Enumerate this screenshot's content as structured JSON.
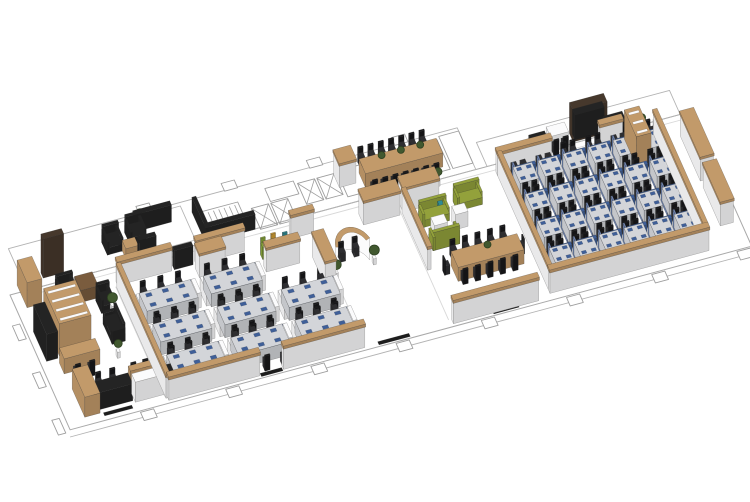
{
  "meta": {
    "description": "Axonometric 3D render of a long open-plan office floor",
    "canvas_width": 750,
    "canvas_height": 502,
    "background": "#ffffff"
  },
  "palette": {
    "white": "#fbfbfc",
    "desk": "#d3d5d9",
    "panel": "#3f5f98",
    "panel2": "#7288b4",
    "wood": "#c29a6a",
    "brown": "#7a5c3e",
    "darkbrown": "#46382c",
    "black": "#242424",
    "chairc": "#2e2e31",
    "chairdark": "#18181a",
    "green": "#93a13b",
    "green2": "#86a437",
    "yellow": "#d09d33",
    "teal": "#2e8b94",
    "plantc": "#41582f",
    "plantedge": "#2c3f20",
    "mat": "#1d1d1d",
    "line": "#b3b3b3",
    "linesoft": "#d8d8d8",
    "linedark": "#9e9e9e",
    "slabedge": "#a9a9a9"
  },
  "projection": {
    "origin": [
      10,
      295
    ],
    "ux": [
      0.284,
      -0.0765
    ],
    "vy": [
      0.143,
      0.321
    ],
    "hz": 0.5
  },
  "zones": [
    {
      "id": "floor-slab",
      "label": "Floor slab, core linework and columns",
      "items": [
        {
          "k": "floorfill",
          "x": 0,
          "y": 0,
          "w": 2400,
          "d": 420
        },
        {
          "k": "outline",
          "x": 60,
          "y": -130,
          "w": 1580,
          "d": 130,
          "c": "line"
        },
        {
          "k": "outline",
          "x": 1680,
          "y": -75,
          "w": 680,
          "d": 75,
          "c": "line"
        },
        {
          "k": "outline",
          "x": 420,
          "y": -120,
          "w": 240,
          "d": 106,
          "c": "line"
        },
        {
          "k": "line",
          "x1": 60,
          "y1": 16,
          "x2": 2400,
          "y2": 16,
          "c": "linesoft"
        },
        {
          "k": "line",
          "x1": 344,
          "y1": 56,
          "x2": 344,
          "y2": 398,
          "c": "linesoft"
        },
        {
          "k": "line",
          "x1": 1046,
          "y1": 56,
          "x2": 1046,
          "y2": 398,
          "c": "linesoft"
        },
        {
          "k": "line",
          "x1": 1344,
          "y1": 56,
          "x2": 1344,
          "y2": 398,
          "c": "linesoft"
        },
        {
          "k": "line",
          "x1": -10,
          "y1": 440,
          "x2": 2404,
          "y2": 440,
          "c": "line"
        },
        {
          "k": "stairs",
          "x": 706,
          "y": -88,
          "w": 140,
          "d": 86,
          "n": 7
        },
        {
          "k": "xroom",
          "x": 880,
          "y": -60,
          "w": 60,
          "d": 65
        },
        {
          "k": "xroom",
          "x": 948,
          "y": -60,
          "w": 60,
          "d": 65
        },
        {
          "k": "xroom",
          "x": 1060,
          "y": -95,
          "w": 60,
          "d": 65
        },
        {
          "k": "xroom",
          "x": 1128,
          "y": -95,
          "w": 60,
          "d": 65
        },
        {
          "k": "outline",
          "x": 950,
          "y": -105,
          "w": 100,
          "d": 40,
          "c": "linedark"
        },
        {
          "k": "outline",
          "x": 1200,
          "y": -100,
          "w": 110,
          "d": 80,
          "c": "linedark"
        },
        {
          "k": "outline",
          "x": 1380,
          "y": -112,
          "w": 56,
          "d": 92,
          "c": "linedark"
        },
        {
          "k": "outline",
          "x": 1442,
          "y": -112,
          "w": 56,
          "d": 92,
          "c": "linedark"
        },
        {
          "k": "outline",
          "x": 1504,
          "y": -112,
          "w": 56,
          "d": 92,
          "c": "linedark"
        },
        {
          "k": "outline",
          "x": 1570,
          "y": -120,
          "w": 70,
          "d": 100,
          "c": "linedark"
        },
        {
          "k": "box",
          "x": 480,
          "y": -95,
          "w": 130,
          "d": 13,
          "h": 34,
          "c": "black"
        },
        {
          "k": "box",
          "x": 688,
          "y": -94,
          "w": 14,
          "d": 96,
          "h": 30,
          "c": "black"
        },
        {
          "k": "box",
          "x": 688,
          "y": -12,
          "w": 175,
          "d": 13,
          "h": 30,
          "c": "black"
        },
        {
          "k": "box",
          "x": 455,
          "y": -12,
          "w": 60,
          "d": 12,
          "h": 40,
          "c": "black"
        },
        {
          "k": "colrun",
          "x": 246,
          "y": 424,
          "n": 8,
          "dx": 300,
          "w": 46,
          "d": 26
        },
        {
          "k": "colrun",
          "x": 520,
          "y": -152,
          "n": 4,
          "dx": 300,
          "w": 46,
          "d": 24
        },
        {
          "k": "colrun",
          "x": -36,
          "y": 88,
          "n": 1,
          "dx": 0,
          "w": 26,
          "d": 46
        },
        {
          "k": "colrun",
          "x": -40,
          "y": 236,
          "n": 1,
          "dx": 0,
          "w": 26,
          "d": 46
        },
        {
          "k": "colrun",
          "x": -44,
          "y": 380,
          "n": 1,
          "dx": 0,
          "w": 26,
          "d": 46
        }
      ]
    },
    {
      "id": "north-lounge",
      "label": "Informal lounge, dark sofas",
      "items": [
        {
          "k": "sofa",
          "x": 362,
          "y": -78,
          "w": 56,
          "d": 40,
          "dir": "s",
          "c": "black"
        },
        {
          "k": "sofa",
          "x": 448,
          "y": -88,
          "w": 56,
          "d": 40,
          "dir": "s",
          "c": "black"
        },
        {
          "k": "box",
          "x": 415,
          "y": -40,
          "w": 44,
          "d": 26,
          "h": 20,
          "c": "wood"
        },
        {
          "k": "plant",
          "x": 505,
          "y": -92,
          "s": 5
        }
      ]
    },
    {
      "id": "executive-suite",
      "label": "Executive suite with bookcase and lounge",
      "items": [
        {
          "k": "box",
          "x": 128,
          "y": -38,
          "w": 72,
          "d": 16,
          "h": 78,
          "c": "darkbrown"
        },
        {
          "k": "box",
          "x": 36,
          "y": -22,
          "w": 52,
          "d": 70,
          "h": 50,
          "c": "wood"
        },
        {
          "k": "box",
          "x": 22,
          "y": 120,
          "w": 40,
          "d": 92,
          "h": 54,
          "c": "black"
        },
        {
          "k": "sofa",
          "x": 146,
          "y": 26,
          "w": 58,
          "d": 44,
          "dir": "s",
          "c": "black"
        },
        {
          "k": "box",
          "x": 212,
          "y": 30,
          "w": 62,
          "d": 44,
          "h": 24,
          "c": "brown"
        },
        {
          "k": "sofa",
          "x": 262,
          "y": 80,
          "w": 44,
          "d": 40,
          "dir": "s",
          "c": "black"
        },
        {
          "k": "shelf",
          "x": 70,
          "y": 96,
          "w": 112,
          "d": 110,
          "h": 64,
          "c": "wood",
          "n": 4
        },
        {
          "k": "plant",
          "x": 300,
          "y": 120,
          "s": 5
        },
        {
          "k": "sofa",
          "x": 252,
          "y": 150,
          "w": 46,
          "d": 64,
          "dir": "w",
          "c": "black"
        },
        {
          "k": "box",
          "x": 60,
          "y": 226,
          "w": 126,
          "d": 34,
          "h": 30,
          "c": "wood"
        },
        {
          "k": "chair",
          "x": 96,
          "y": 278,
          "f": "n"
        },
        {
          "k": "chair",
          "x": 146,
          "y": 278,
          "f": "n"
        },
        {
          "k": "plant",
          "x": 254,
          "y": 252,
          "s": 4
        },
        {
          "k": "box",
          "x": 64,
          "y": 308,
          "w": 54,
          "d": 88,
          "h": 40,
          "c": "wood"
        },
        {
          "k": "box",
          "x": 118,
          "y": 352,
          "w": 120,
          "d": 34,
          "h": 34,
          "c": "black"
        },
        {
          "k": "chair",
          "x": 148,
          "y": 330,
          "f": "s"
        },
        {
          "k": "chair",
          "x": 198,
          "y": 330,
          "f": "s"
        },
        {
          "k": "box",
          "x": 240,
          "y": 350,
          "w": 112,
          "d": 16,
          "h": 46,
          "c": "wood"
        },
        {
          "k": "box",
          "x": 244,
          "y": 366,
          "w": 106,
          "d": 26,
          "h": 40,
          "c": "white"
        },
        {
          "k": "chair",
          "x": 272,
          "y": 330,
          "f": "s"
        },
        {
          "k": "chair",
          "x": 314,
          "y": 330,
          "f": "s"
        },
        {
          "k": "sofa",
          "x": 358,
          "y": 330,
          "w": 40,
          "d": 46,
          "dir": "w",
          "c": "black"
        },
        {
          "k": "plant",
          "x": 404,
          "y": 352,
          "s": 4
        },
        {
          "k": "mat",
          "x": 128,
          "y": 398,
          "w": 100,
          "d": 10
        }
      ]
    },
    {
      "id": "open-office-west",
      "label": "Open office west, 8 bench clusters",
      "items": [
        {
          "k": "wall",
          "x": 352,
          "y": 42,
          "w": 190,
          "d": 12
        },
        {
          "k": "box",
          "x": 552,
          "y": 40,
          "w": 66,
          "d": 13,
          "h": 38,
          "c": "black"
        },
        {
          "k": "wall",
          "x": 628,
          "y": 42,
          "w": 170,
          "d": 12
        },
        {
          "k": "wall",
          "x": 962,
          "y": 42,
          "w": 80,
          "d": 12
        },
        {
          "k": "wall",
          "x": 346,
          "y": 60,
          "w": 12,
          "d": 344
        },
        {
          "k": "cab",
          "x": 620,
          "y": 64,
          "w": 90,
          "d": 30
        },
        {
          "k": "benchgrid",
          "x": 390,
          "y": 128,
          "cols": 3,
          "rows": 3,
          "dx": 226,
          "dy": 96,
          "skip": [
            [
              2,
              0
            ]
          ]
        },
        {
          "k": "wall",
          "x": 352,
          "y": 400,
          "w": 320,
          "d": 12
        },
        {
          "k": "wall",
          "x": 756,
          "y": 400,
          "w": 286,
          "d": 12
        },
        {
          "k": "mat",
          "x": 676,
          "y": 406,
          "w": 76,
          "d": 10
        },
        {
          "k": "cab",
          "x": 1004,
          "y": 120,
          "w": 38,
          "d": 90
        }
      ]
    },
    {
      "id": "reception-cafe",
      "label": "Curved reception desk and cafe counter",
      "items": [
        {
          "k": "arcdesk",
          "cx": 1120,
          "cy": 188,
          "r": 62
        },
        {
          "k": "chair",
          "x": 1094,
          "y": 150,
          "f": "s"
        },
        {
          "k": "chair",
          "x": 1144,
          "y": 146,
          "f": "s"
        },
        {
          "k": "plant",
          "x": 1050,
          "y": 196,
          "s": 5
        },
        {
          "k": "plant",
          "x": 1190,
          "y": 184,
          "s": 5
        },
        {
          "k": "cab",
          "x": 1210,
          "y": 36,
          "w": 128,
          "d": 34
        },
        {
          "k": "cab",
          "x": 838,
          "y": 110,
          "w": 118,
          "d": 18
        },
        {
          "k": "stool",
          "x": 852,
          "y": 84,
          "c": "green2"
        },
        {
          "k": "stool",
          "x": 890,
          "y": 80,
          "c": "yellow"
        },
        {
          "k": "stool",
          "x": 928,
          "y": 86,
          "c": "teal"
        },
        {
          "k": "box",
          "x": 884,
          "y": 98,
          "w": 30,
          "d": 12,
          "h": 16,
          "c": "wood"
        },
        {
          "k": "mat",
          "x": 1090,
          "y": 406,
          "w": 110,
          "d": 10
        }
      ]
    },
    {
      "id": "boardroom",
      "label": "Boardroom, 16-seat conference table",
      "items": [
        {
          "k": "cab",
          "x": 1186,
          "y": -92,
          "w": 58,
          "d": 40
        },
        {
          "k": "table",
          "x": 1268,
          "y": -78,
          "w": 272,
          "d": 46,
          "p": 3
        },
        {
          "k": "chairrow",
          "x": 1288,
          "y": -100,
          "n": 7,
          "dx": 36,
          "f": "s"
        },
        {
          "k": "chairrow",
          "x": 1288,
          "y": -12,
          "n": 7,
          "dx": 36,
          "f": "n"
        },
        {
          "k": "plant",
          "x": 1300,
          "y": 14,
          "s": 4
        },
        {
          "k": "plant",
          "x": 1400,
          "y": 14,
          "s": 4
        },
        {
          "k": "plant",
          "x": 1500,
          "y": 14,
          "s": 4
        }
      ]
    },
    {
      "id": "lounge-meeting",
      "label": "Green lounge sofas and 12-seat meeting table",
      "items": [
        {
          "k": "cab",
          "x": 1352,
          "y": 30,
          "w": 126,
          "d": 34
        },
        {
          "k": "sofa",
          "x": 1392,
          "y": 92,
          "w": 94,
          "d": 30,
          "dir": "s",
          "c": "green"
        },
        {
          "k": "box",
          "x": 1416,
          "y": 130,
          "w": 46,
          "d": 26,
          "h": 22,
          "c": "white"
        },
        {
          "k": "sofa",
          "x": 1392,
          "y": 164,
          "w": 94,
          "d": 30,
          "dir": "n",
          "c": "green"
        },
        {
          "k": "sofa",
          "x": 1524,
          "y": 72,
          "w": 88,
          "d": 30,
          "dir": "s",
          "c": "green"
        },
        {
          "k": "stool",
          "x": 1466,
          "y": 100,
          "c": "teal"
        },
        {
          "k": "box",
          "x": 1492,
          "y": 126,
          "w": 44,
          "d": 26,
          "h": 30,
          "c": "white"
        },
        {
          "k": "table",
          "x": 1428,
          "y": 248,
          "w": 232,
          "d": 50,
          "p": 1
        },
        {
          "k": "chairrow",
          "x": 1448,
          "y": 226,
          "n": 5,
          "dx": 44,
          "f": "s"
        },
        {
          "k": "chairrow",
          "x": 1448,
          "y": 302,
          "n": 5,
          "dx": 44,
          "f": "n"
        },
        {
          "k": "chair",
          "x": 1404,
          "y": 264,
          "f": "e"
        },
        {
          "k": "chair",
          "x": 1666,
          "y": 264,
          "f": "w"
        },
        {
          "k": "wall",
          "x": 1348,
          "y": 64,
          "w": 12,
          "d": 180
        },
        {
          "k": "wall",
          "x": 1354,
          "y": 400,
          "w": 300,
          "d": 12
        },
        {
          "k": "mat",
          "x": 1494,
          "y": 406,
          "w": 90,
          "d": 10
        }
      ]
    },
    {
      "id": "open-office-east",
      "label": "Open office east, 24 workstation pods",
      "items": [
        {
          "k": "wall",
          "x": 1700,
          "y": 22,
          "w": 190,
          "d": 12
        },
        {
          "k": "wall",
          "x": 2060,
          "y": 22,
          "w": 80,
          "d": 12
        },
        {
          "k": "wall",
          "x": 1700,
          "y": 34,
          "w": 12,
          "d": 354
        },
        {
          "k": "wall",
          "x": 1700,
          "y": 388,
          "w": 560,
          "d": 12
        },
        {
          "k": "wall",
          "x": 2248,
          "y": 34,
          "w": 12,
          "d": 354
        },
        {
          "k": "podgrid",
          "x": 1742,
          "y": 58,
          "cols": 6,
          "rows": 4,
          "dx": 88,
          "dy": 84
        }
      ]
    },
    {
      "id": "executive-east",
      "label": "East executive area with media wall and shelving",
      "items": [
        {
          "k": "box",
          "x": 1900,
          "y": -24,
          "w": 64,
          "d": 30,
          "h": 30,
          "c": "white"
        },
        {
          "k": "chair",
          "x": 1914,
          "y": 12,
          "f": "n"
        },
        {
          "k": "chair",
          "x": 1948,
          "y": 10,
          "f": "n"
        },
        {
          "k": "box",
          "x": 1836,
          "y": -20,
          "w": 56,
          "d": 26,
          "h": 26,
          "c": "black"
        },
        {
          "k": "chair",
          "x": 1856,
          "y": 12,
          "f": "n"
        },
        {
          "k": "box",
          "x": 1985,
          "y": -30,
          "w": 120,
          "d": 26,
          "h": 62,
          "c": "darkbrown"
        },
        {
          "k": "box",
          "x": 1993,
          "y": -26,
          "w": 104,
          "d": 18,
          "h": 50,
          "c": "black",
          "b": 2
        },
        {
          "k": "box",
          "x": 2096,
          "y": -14,
          "w": 66,
          "d": 26,
          "h": 28,
          "c": "black"
        },
        {
          "k": "chair",
          "x": 2120,
          "y": 16,
          "f": "n"
        },
        {
          "k": "shelf",
          "x": 2150,
          "y": 26,
          "w": 52,
          "d": 84,
          "h": 58,
          "c": "wood",
          "n": 3
        },
        {
          "k": "chair",
          "x": 2240,
          "y": 44,
          "f": "w"
        },
        {
          "k": "chair",
          "x": 2240,
          "y": 70,
          "f": "w"
        },
        {
          "k": "plant",
          "x": 2216,
          "y": 16,
          "s": 4
        },
        {
          "k": "cab",
          "x": 2330,
          "y": 60,
          "w": 46,
          "d": 140
        },
        {
          "k": "cab",
          "x": 2330,
          "y": 220,
          "w": 46,
          "d": 120
        }
      ]
    }
  ]
}
